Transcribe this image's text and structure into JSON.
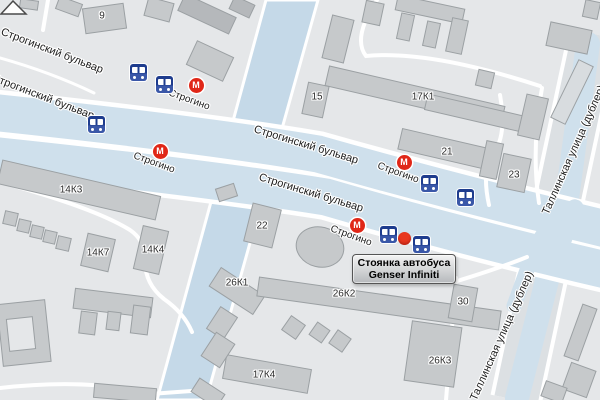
{
  "title": "Карта района Строгино",
  "streets": {
    "boulevard": "Строгинский бульвар",
    "tallinskaya": "Таллинская улица (дублер)"
  },
  "metro": {
    "name": "Строгино",
    "symbol": "М"
  },
  "building_labels": [
    "9",
    "15",
    "17К1",
    "21",
    "23",
    "14К3",
    "14К7",
    "14К4",
    "22",
    "26К1",
    "26К2",
    "26К3",
    "30",
    "17К4"
  ],
  "callout": {
    "line1": "Стоянка автобуса",
    "line2": "Genser Infiniti"
  },
  "colors": {
    "background": "#e5e7e9",
    "road_blue": "#cfe0ec",
    "water": "#c5d9e8",
    "street_gray": "#dce0e3",
    "building": "#c6c9cb",
    "building_dark": "#b5b8bb",
    "metro_red": "#e02718",
    "bus_blue": "#1e3c8e",
    "marker_red": "#e8371f"
  }
}
